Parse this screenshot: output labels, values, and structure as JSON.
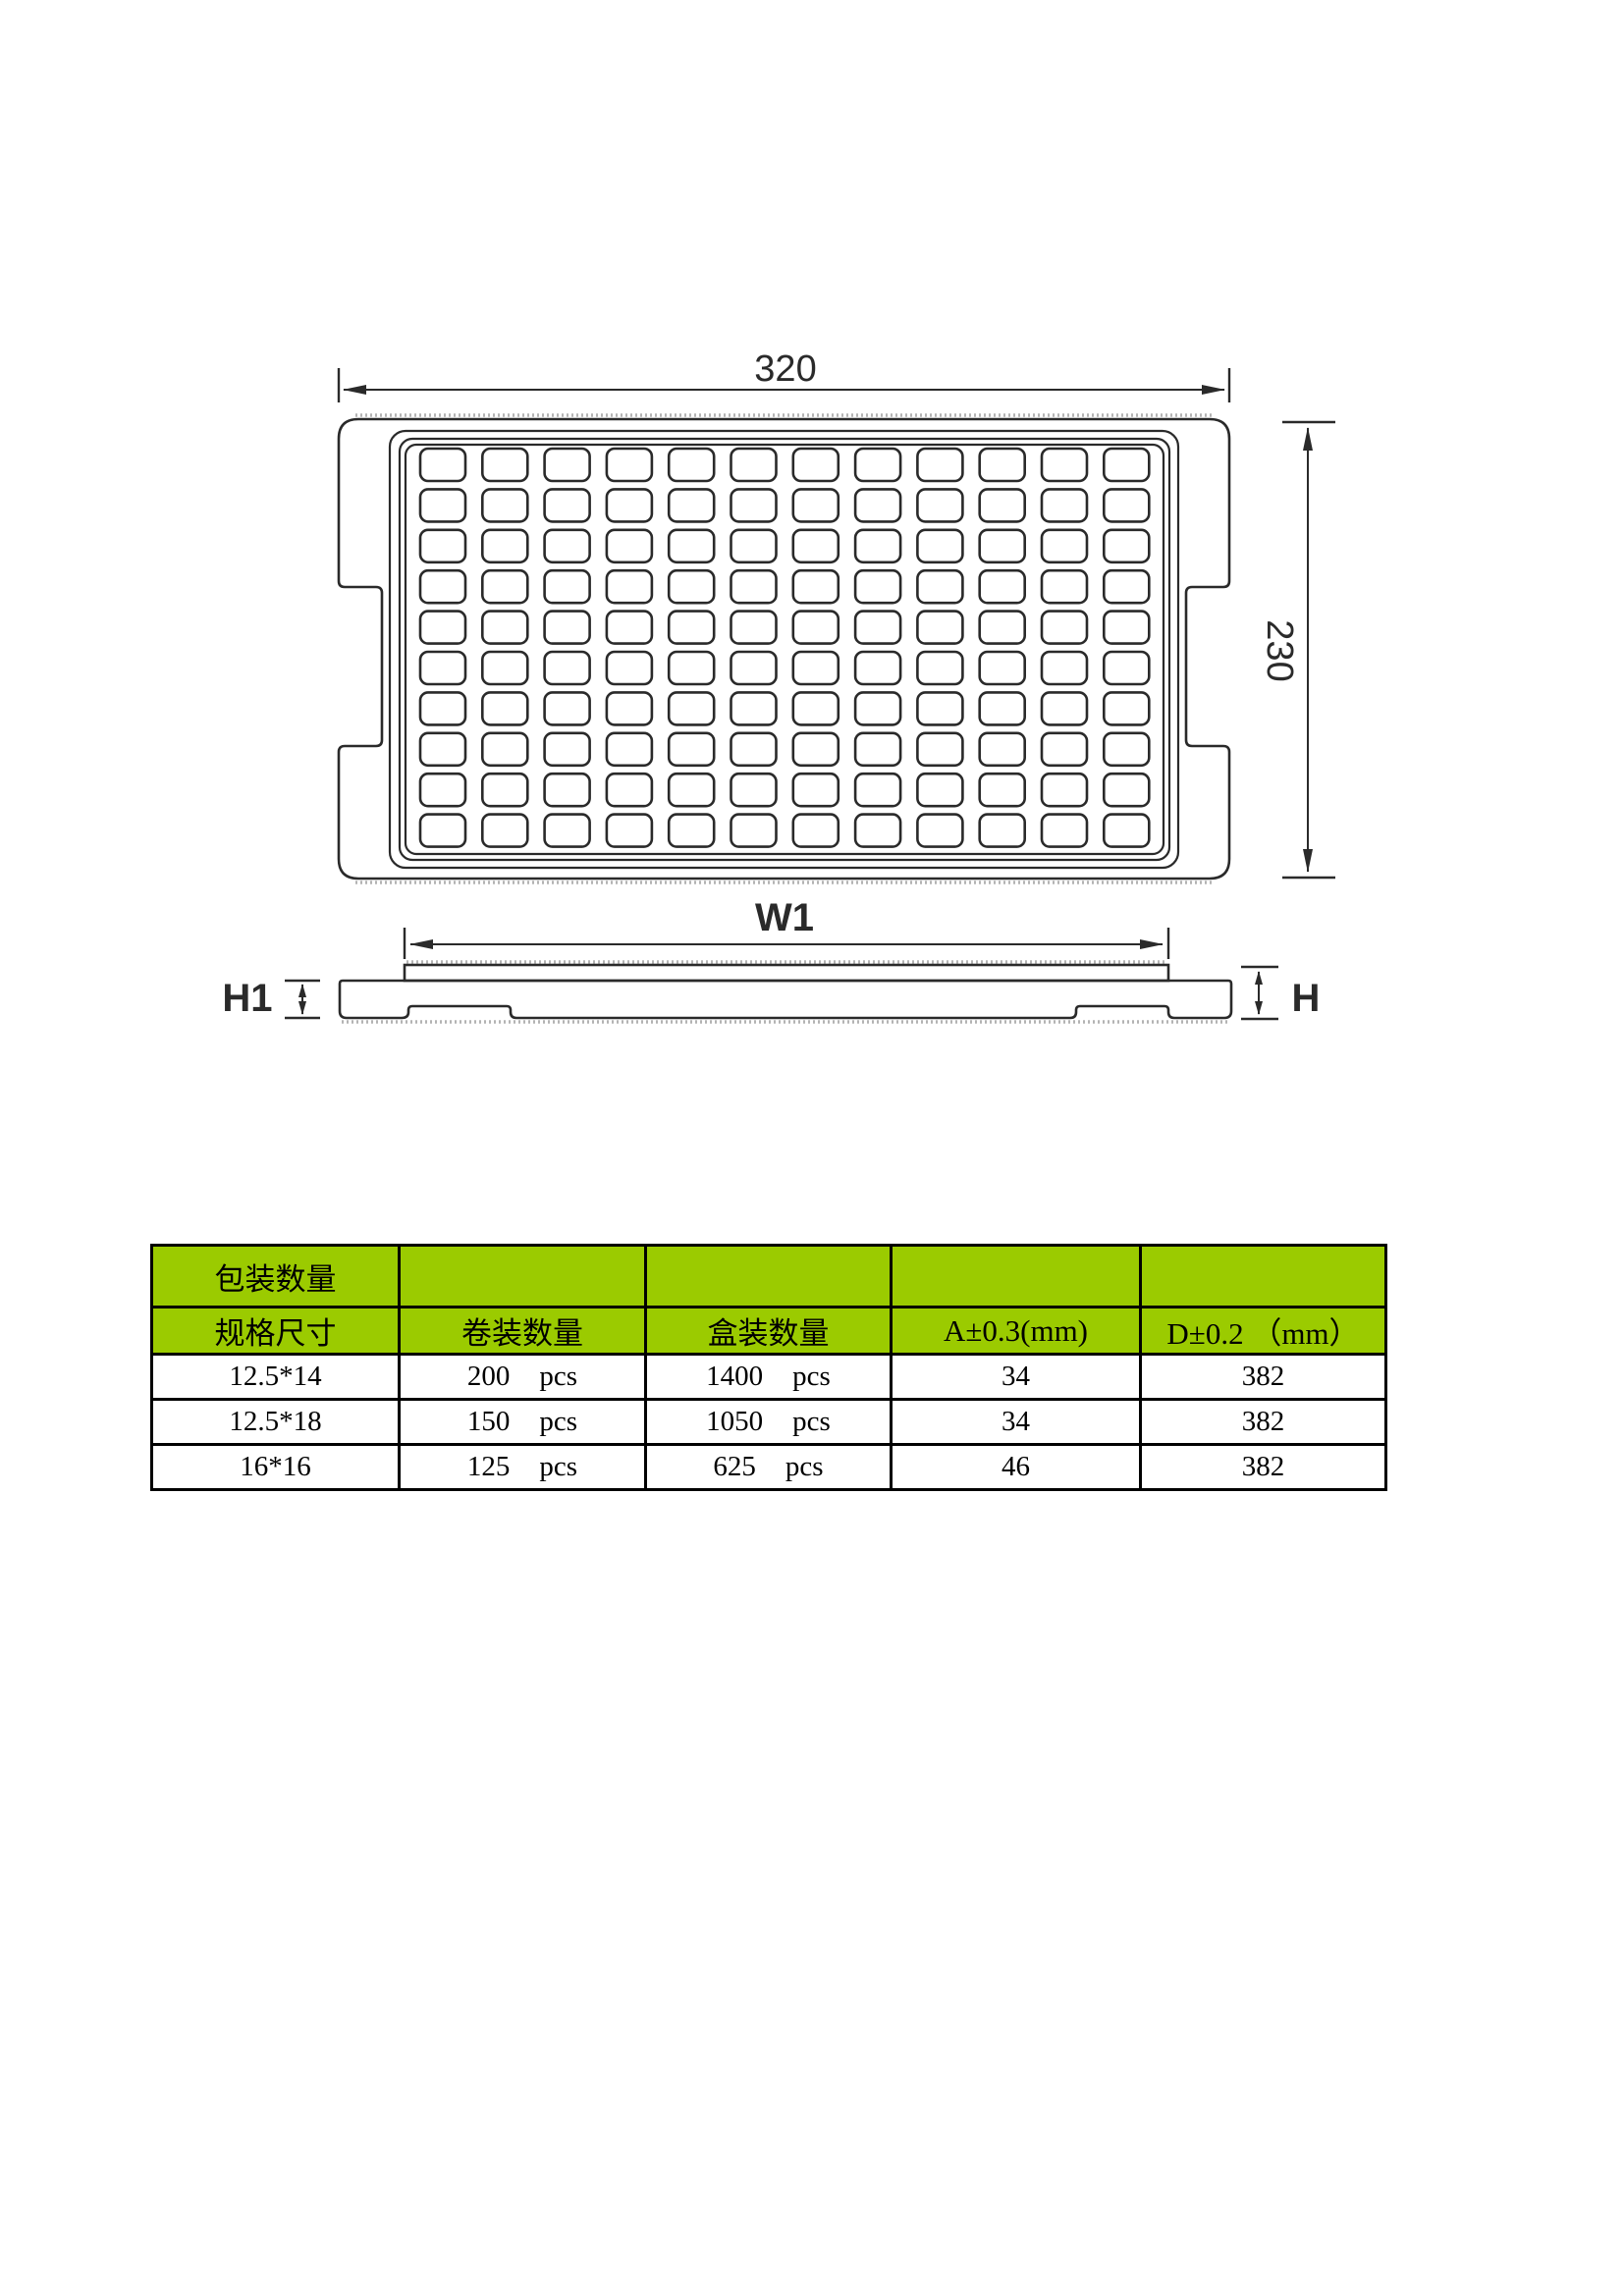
{
  "drawing": {
    "line_color": "#2a2a2a",
    "top_view": {
      "width_label": "320",
      "height_label": "230",
      "pockets": {
        "columns": 12,
        "rows": 10
      }
    },
    "side_view": {
      "width_label": "W1",
      "left_height_label": "H1",
      "right_height_label": "H"
    }
  },
  "table": {
    "header_bg": "#9bcb00",
    "header_band_label": "包装数量",
    "columns": [
      "规格尺寸",
      "卷装数量",
      "盒装数量",
      "A±0.3(mm)",
      "D±0.2 （mm）"
    ],
    "rows": [
      {
        "size": "12.5*14",
        "roll_qty": "200",
        "roll_unit": "pcs",
        "box_qty": "1400",
        "box_unit": "pcs",
        "a": "34",
        "d": "382"
      },
      {
        "size": "12.5*18",
        "roll_qty": "150",
        "roll_unit": "pcs",
        "box_qty": "1050",
        "box_unit": "pcs",
        "a": "34",
        "d": "382"
      },
      {
        "size": "16*16",
        "roll_qty": "125",
        "roll_unit": "pcs",
        "box_qty": "625",
        "box_unit": "pcs",
        "a": "46",
        "d": "382"
      }
    ]
  }
}
